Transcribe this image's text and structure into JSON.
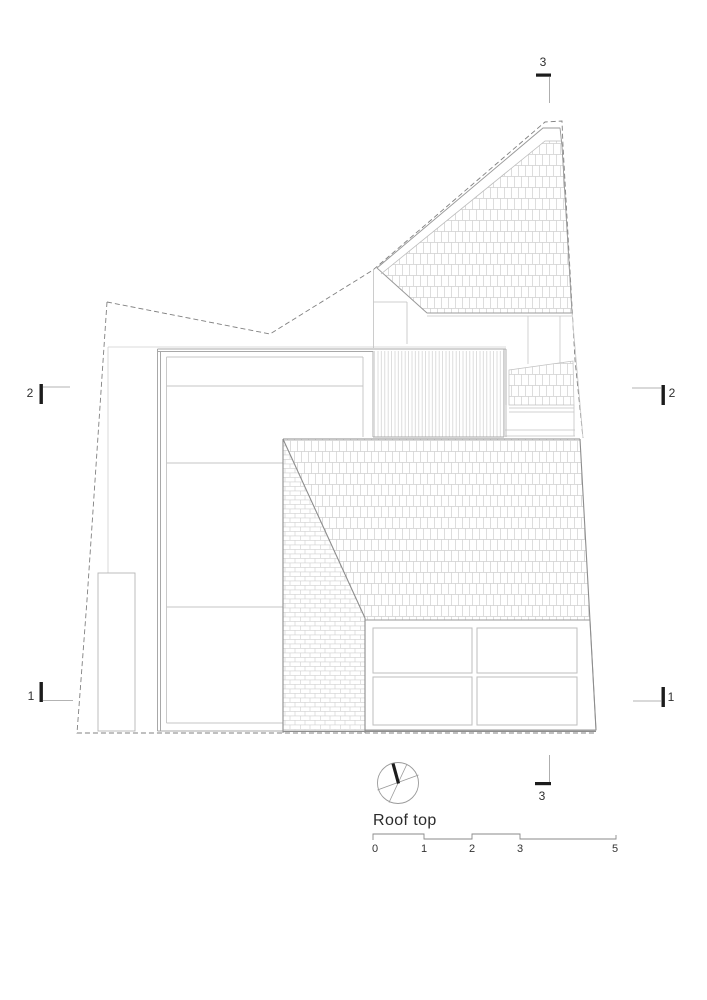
{
  "page": {
    "background": "#ffffff"
  },
  "drawing": {
    "title": "Roof top",
    "section_markers": {
      "top": "3",
      "bottom": "3",
      "left_upper": "2",
      "right_upper": "2",
      "left_lower": "1",
      "right_lower": "1"
    },
    "scale_bar": {
      "labels": [
        "0",
        "1",
        "2",
        "3",
        "5"
      ]
    },
    "north_arrow_icon": "compass-north-arrow",
    "colors": {
      "hatch": "#cfcfcf",
      "line_light": "#c4c4c4",
      "line_medium": "#9a9a9a",
      "boundary_dashed": "#808080",
      "marker": "#1c1c1c",
      "text": "#2e2e2e"
    }
  }
}
